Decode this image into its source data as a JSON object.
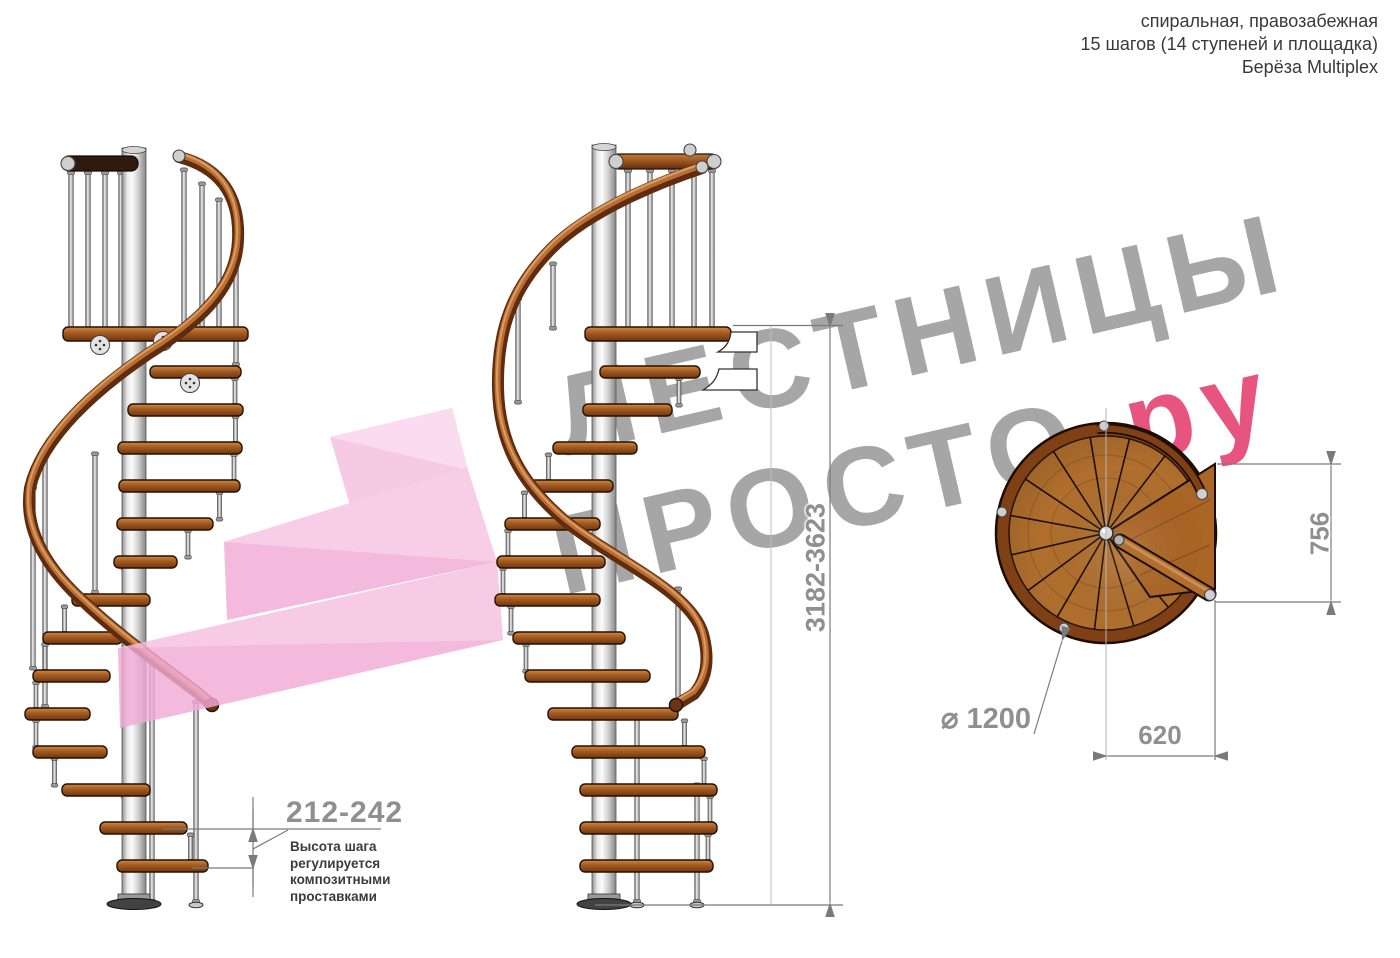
{
  "header": {
    "line1": "спиральная, правозабежная",
    "line2": "15 шагов (14 ступеней и площадка)",
    "line3": "Берёза Multiplex"
  },
  "watermark": {
    "word1": "ЛЕСТНИЦЫ",
    "word2": "ПРОСТО",
    "word2_suffix": ".ру",
    "gray_color": "#a6a6a6",
    "pink_color": "#e75480"
  },
  "dimensions": {
    "total_height": "3182-3623",
    "landing_depth": "756",
    "landing_width": "620",
    "diameter": "⌀ 1200",
    "step_height": "212-242",
    "note_lines": [
      "Высота шага",
      "регулируется",
      "композитными",
      "проставками"
    ]
  },
  "colors": {
    "wood": "#b06f2e",
    "wood_dark": "#7e4014",
    "handrail": "#a0521f",
    "metal": "#d9d9d9",
    "dimension_text": "#8f8f8f",
    "pink_logo": "#f2abd6"
  }
}
